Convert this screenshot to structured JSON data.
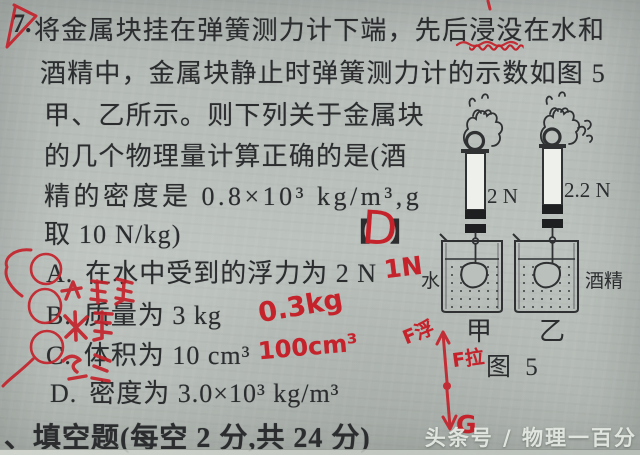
{
  "page": {
    "question_number": "7.",
    "line1_pre": "将金属块挂在弹簧测力计下端，先后",
    "line1_underlined": "浸没",
    "line1_post": "在水和",
    "line2": "酒精中，金属块静止时弹簧测力计的示数如图 5",
    "line3": "甲、乙所示。则下列关于金属块",
    "line4": "的几个物理量计算正确的是(酒",
    "line5": "精的密度是 0.8×10³ kg/m³,g",
    "line6": "取 10 N/kg)",
    "bracket_open": "【",
    "bracket_close": "】"
  },
  "options": [
    {
      "label": "A.",
      "text": "在水中受到的浮力为 2 N"
    },
    {
      "label": "B.",
      "text": "质量为 3 kg"
    },
    {
      "label": "C.",
      "text": "体积为 10 cm³"
    },
    {
      "label": "D.",
      "text": "密度为 3.0×10³ kg/m³"
    }
  ],
  "figure": {
    "reading_jia": "2 N",
    "reading_yi": "2.2 N",
    "liquid_jia": "水",
    "liquid_yi": "酒精",
    "label_jia": "甲",
    "label_yi": "乙",
    "caption": "图 5"
  },
  "annotations": {
    "answer": "D",
    "option_a_correction": "1N",
    "option_b_correction": "0.3kg",
    "option_c_correction": "100cm³",
    "force_buoyancy": "F浮",
    "force_tension": "F拉",
    "force_gravity": "G"
  },
  "footer": {
    "section_heading": "、填空题(每空 2 分,共 24 分)"
  },
  "watermark": "头条号 / 物理一百分",
  "colors": {
    "paper": "#b7bdb9",
    "ink": "#2b2d2f",
    "red_ink": "#c4232b"
  }
}
